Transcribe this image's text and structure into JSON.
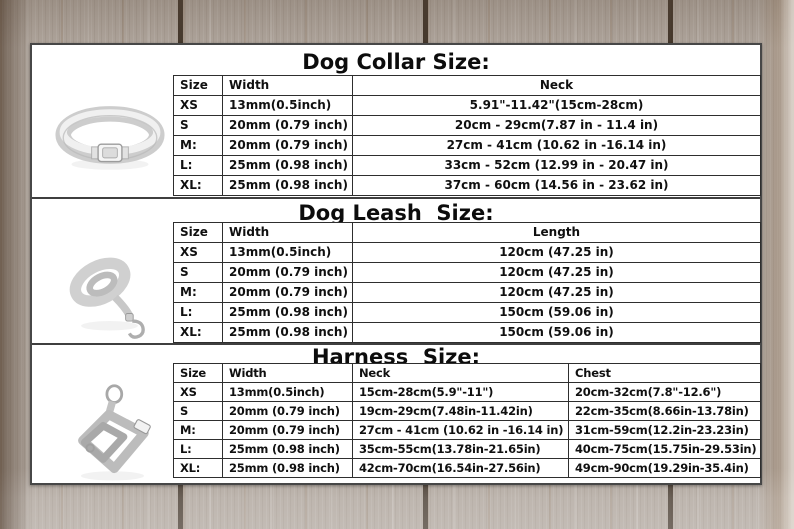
{
  "sections": [
    {
      "title": "Dog Collar Size:",
      "product": "dog collar",
      "columns": [
        "Size",
        "Width",
        "Neck"
      ],
      "rows": [
        [
          "XS",
          "13mm(0.5inch)",
          "5.91\"-11.42\"(15cm-28cm)"
        ],
        [
          "S",
          "20mm (0.79 inch)",
          "20cm - 29cm(7.87 in - 11.4 in)"
        ],
        [
          "M:",
          "20mm (0.79 inch)",
          "27cm - 41cm (10.62 in -16.14 in)"
        ],
        [
          "L:",
          "25mm (0.98 inch)",
          "33cm - 52cm (12.99 in - 20.47 in)"
        ],
        [
          "XL:",
          "25mm (0.98 inch)",
          "37cm - 60cm (14.56 in - 23.62 in)"
        ]
      ]
    },
    {
      "title": "Dog Leash  Size:",
      "product": "dog leash",
      "columns": [
        "Size",
        "Width",
        "Length"
      ],
      "rows": [
        [
          "XS",
          "13mm(0.5inch)",
          "120cm (47.25 in)"
        ],
        [
          "S",
          "20mm (0.79 inch)",
          "120cm (47.25 in)"
        ],
        [
          "M:",
          "20mm (0.79 inch)",
          "120cm (47.25 in)"
        ],
        [
          "L:",
          "25mm (0.98 inch)",
          "150cm (59.06 in)"
        ],
        [
          "XL:",
          "25mm (0.98 inch)",
          "150cm (59.06 in)"
        ]
      ]
    },
    {
      "title": "Harness  Size:",
      "product": "dog harness",
      "columns": [
        "Size",
        "Width",
        "Neck",
        "Chest"
      ],
      "rows": [
        [
          "XS",
          "13mm(0.5inch)",
          "15cm-28cm(5.9\"-11\")",
          "20cm-32cm(7.8\"-12.6\")"
        ],
        [
          "S",
          "20mm (0.79 inch)",
          "19cm-29cm(7.48in-11.42in)",
          "22cm-35cm(8.66in-13.78in)"
        ],
        [
          "M:",
          "20mm (0.79 inch)",
          "27cm - 41cm (10.62 in -16.14 in)",
          "31cm-59cm(12.2in-23.23in)"
        ],
        [
          "L:",
          "25mm (0.98 inch)",
          "35cm-55cm(13.78in-21.65in)",
          "40cm-75cm(15.75in-29.53in)"
        ],
        [
          "XL:",
          "25mm (0.98 inch)",
          "42cm-70cm(16.54in-27.56in)",
          "49cm-90cm(19.29in-35.4in)"
        ]
      ]
    }
  ],
  "colors": {
    "panel_background": "#ffffff",
    "panel_border": "#474747",
    "table_border": "#2e2e2e",
    "text": "#101010",
    "wood_base": "#aea49b",
    "wood_gap": "#2b1e12"
  }
}
